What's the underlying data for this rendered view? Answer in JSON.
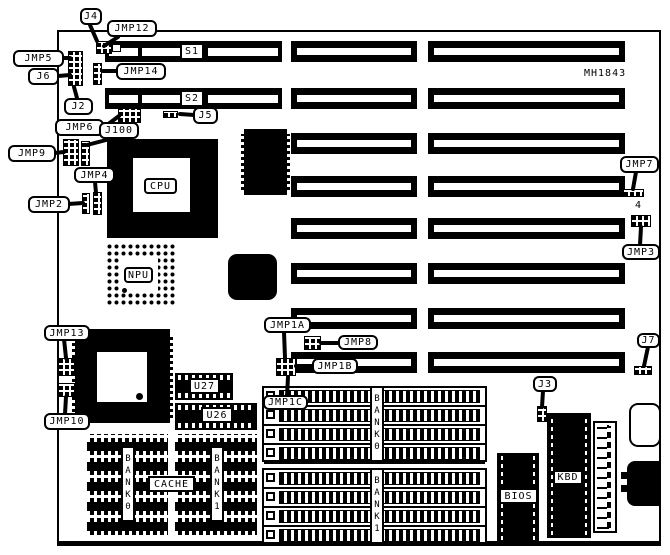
{
  "board": {
    "part_number": "MH1843"
  },
  "slots": {
    "s1": "S1",
    "s2": "S2"
  },
  "chips": {
    "cpu": "CPU",
    "npu": "NPU",
    "u27": "U27",
    "u26": "U26",
    "cache": "CACHE",
    "cache_bank0": "BANK0",
    "cache_bank1": "BANK1",
    "simm_bank0": "BANK0",
    "simm_bank1": "BANK1",
    "bios": "BIOS",
    "kbd": "KBD"
  },
  "callouts": {
    "j4": "J4",
    "jmp12": "JMP12",
    "jmp5": "JMP5",
    "j6": "J6",
    "jmp14": "JMP14",
    "j2": "J2",
    "jmp6": "JMP6",
    "j100": "J100",
    "j5": "J5",
    "jmp9": "JMP9",
    "jmp4": "JMP4",
    "jmp2": "JMP2",
    "jmp7": "JMP7",
    "pin4": "4",
    "jmp3": "JMP3",
    "jmp13": "JMP13",
    "jmp10": "JMP10",
    "jmp1a": "JMP1A",
    "jmp8": "JMP8",
    "jmp1b": "JMP1B",
    "jmp1c": "JMP1C",
    "j3": "J3",
    "j7": "J7"
  }
}
